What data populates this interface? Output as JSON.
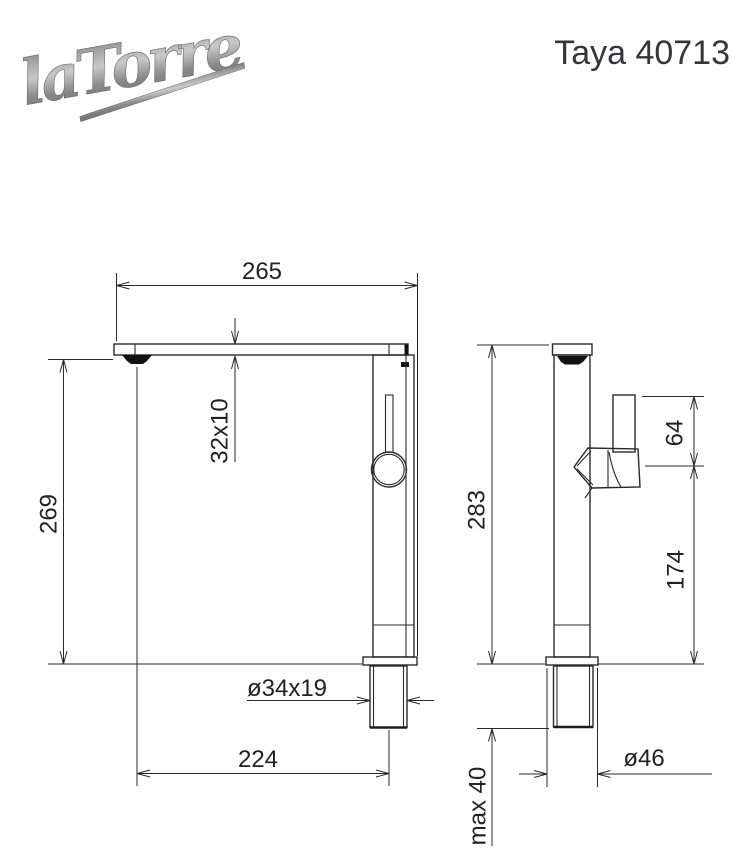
{
  "header": {
    "logo_text": "laTorre",
    "product_title": "Taya 40713"
  },
  "colors": {
    "line": "#2a2a2a",
    "logo_gray": "#8e8e8e",
    "title_text": "#36363a",
    "background": "#ffffff"
  },
  "drawing": {
    "front_view": {
      "label": "front-view",
      "dimensions": {
        "spout_width": "265",
        "spout_section": "32x10",
        "outlet_height": "269",
        "shank_thread": "ø34x19",
        "outlet_to_shank": "224"
      }
    },
    "side_view": {
      "label": "side-view",
      "dimensions": {
        "total_height": "283",
        "handle_length": "64",
        "handle_to_base": "174",
        "base_diameter": "ø46",
        "max_counter_thickness": "max 40"
      }
    }
  }
}
